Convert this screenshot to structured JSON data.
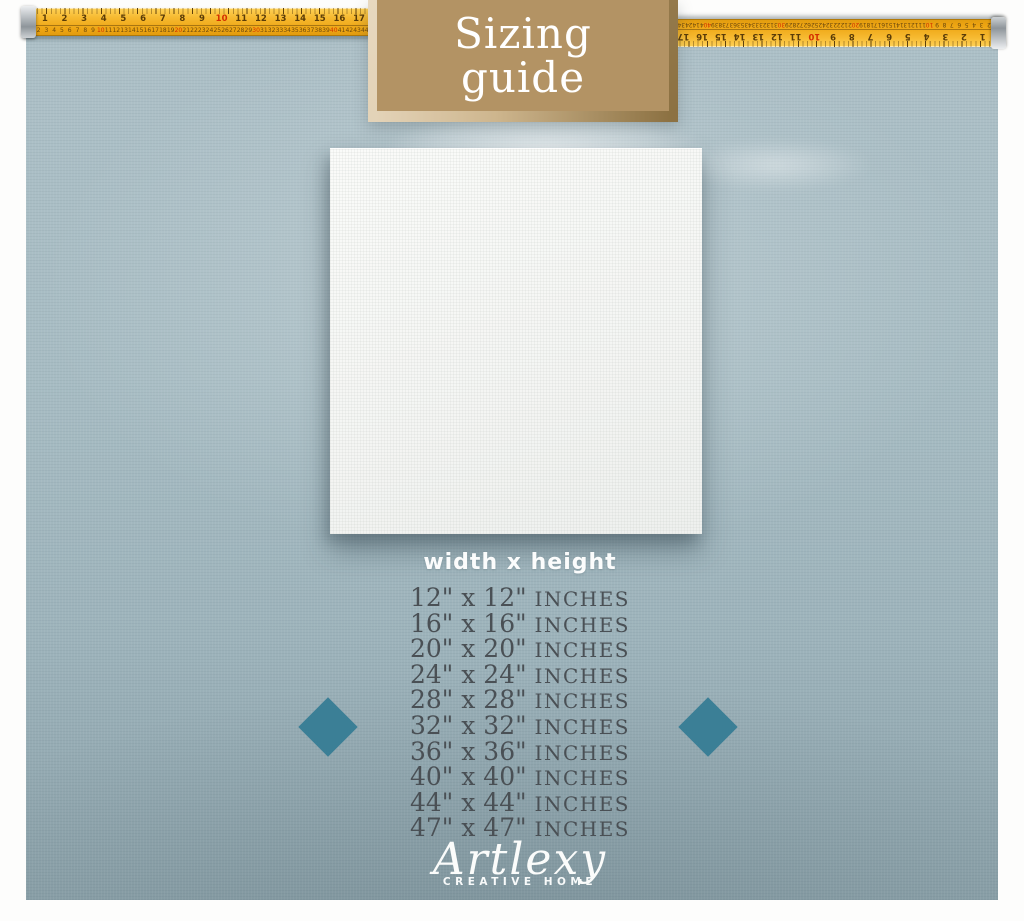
{
  "header_box": {
    "line1": "Sizing",
    "line2": "guide",
    "bg": "#b39364",
    "frame_light": "#e7d8bf",
    "frame_dark": "#8c7142",
    "text_color": "#ffffff"
  },
  "tape": {
    "color": "#f2b02c",
    "inch_numbers": [
      "1",
      "2",
      "3",
      "4",
      "5",
      "6",
      "7",
      "8",
      "9",
      "10",
      "11",
      "12",
      "13",
      "14",
      "15",
      "16",
      "17"
    ],
    "red_inch_numbers": [
      "10"
    ],
    "cm_numbers": [
      "1",
      "2",
      "3",
      "4",
      "5",
      "6",
      "7",
      "8",
      "9",
      "10",
      "11",
      "12",
      "13",
      "14",
      "15",
      "16",
      "17",
      "18",
      "19",
      "20",
      "21",
      "22",
      "23",
      "24",
      "25",
      "26",
      "27",
      "28",
      "29",
      "30",
      "31",
      "32",
      "33",
      "34",
      "35",
      "36",
      "37",
      "38",
      "39",
      "40",
      "41",
      "42",
      "43",
      "44"
    ],
    "red_cm_numbers": [
      "10",
      "20",
      "30",
      "40"
    ]
  },
  "size_guide": {
    "heading": "width x height",
    "separator": "x",
    "quote": "\"",
    "unit": "INCHES",
    "dimensions": [
      "12",
      "16",
      "20",
      "24",
      "28",
      "32",
      "36",
      "40",
      "44",
      "47"
    ],
    "text_color": "#4a5055"
  },
  "decor": {
    "diamond_color": "#3b7f96",
    "panel_color": "#a7bcc3",
    "canvas_color": "#f4f5f3"
  },
  "footer": {
    "brand": "Artlexy",
    "tagline": "CREATIVE HOME"
  }
}
